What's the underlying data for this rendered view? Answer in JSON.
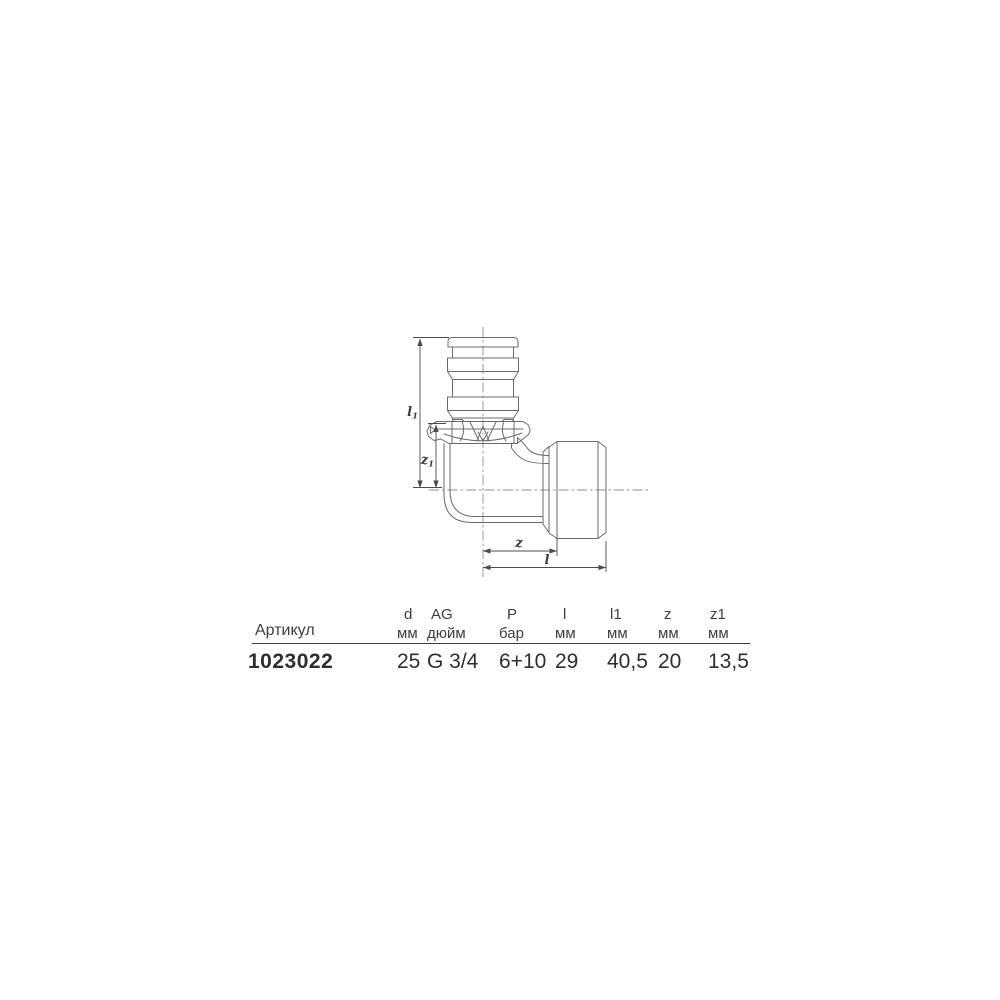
{
  "page": {
    "background": "#ffffff"
  },
  "drawing": {
    "kind": "elbow-adapter-technical-drawing",
    "dimension_labels": {
      "l1_base": "l",
      "l1_sub": "1",
      "z1_base": "z",
      "z1_sub": "1",
      "z": "z",
      "l": "l"
    }
  },
  "table": {
    "article_label": "Артикул",
    "article_value": "1023022",
    "columns": [
      {
        "name": "d",
        "unit": "мм",
        "value": "25"
      },
      {
        "name": "AG",
        "unit": "дюйм",
        "value": "G 3/4"
      },
      {
        "name": "P",
        "unit": "бар",
        "value": "6+10"
      },
      {
        "name": "l",
        "unit": "мм",
        "value": "29"
      },
      {
        "name": "l1",
        "unit": "мм",
        "value": "40,5"
      },
      {
        "name": "z",
        "unit": "мм",
        "value": "20"
      },
      {
        "name": "z1",
        "unit": "мм",
        "value": "13,5"
      }
    ]
  },
  "colors": {
    "part_line": "#6b6b6b",
    "center_line": "#8f8f8f",
    "dimension_line": "#4c4c4c",
    "text": "#3d3d3d"
  }
}
